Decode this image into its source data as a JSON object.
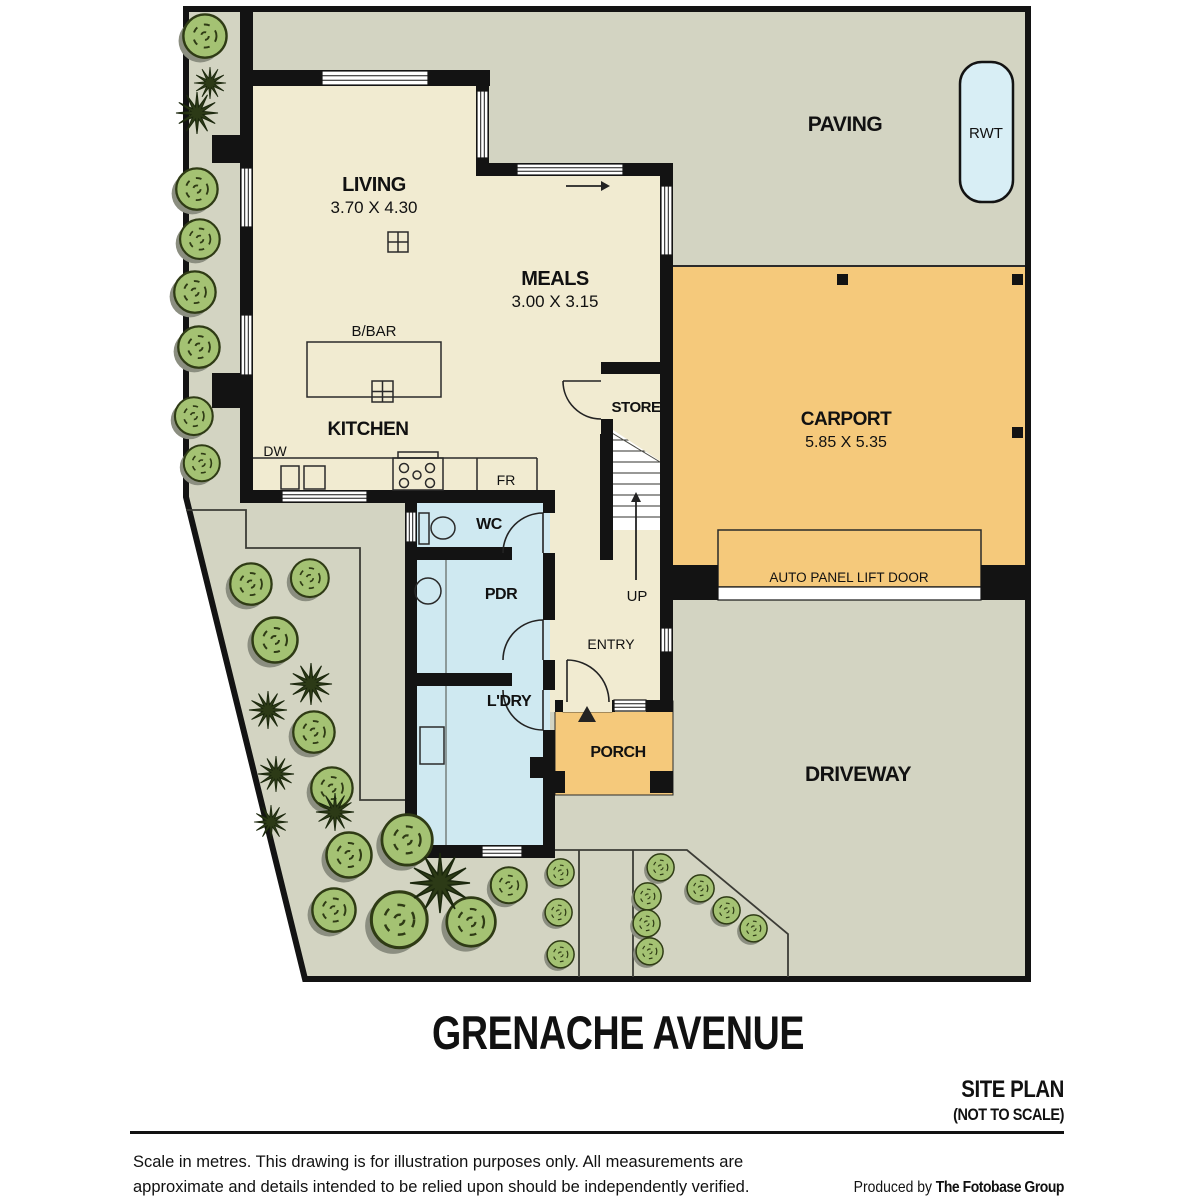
{
  "colors": {
    "site_grey": "#d3d4c2",
    "floor_cream": "#f1ebd1",
    "carport_orange": "#f5c97b",
    "wet_blue": "#cfe9f1",
    "rwt_blue": "#d8eef5",
    "wall_black": "#131313",
    "bush_green": "#a4c273",
    "bush_outline": "#2f3b15",
    "bush_shadow": "#8b8e80",
    "spiky_green": "#2c3a16",
    "line_dark": "#3c3c36",
    "text_dark": "#111111"
  },
  "plan": {
    "rooms": {
      "living": {
        "name": "LIVING",
        "dims": "3.70 X 4.30"
      },
      "meals": {
        "name": "MEALS",
        "dims": "3.00 X 3.15"
      },
      "kitchen": {
        "name": "KITCHEN"
      },
      "bbar": {
        "name": "B/BAR"
      },
      "store": {
        "name": "STORE"
      },
      "wc": {
        "name": "WC"
      },
      "pdr": {
        "name": "PDR"
      },
      "ldry": {
        "name": "L'DRY"
      },
      "entry": {
        "name": "ENTRY"
      },
      "porch": {
        "name": "PORCH"
      },
      "carport": {
        "name": "CARPORT",
        "dims": "5.85 X 5.35"
      }
    },
    "labels": {
      "up": "UP",
      "dw": "DW",
      "fr": "FR",
      "rwt": "RWT",
      "paving": "PAVING",
      "driveway": "DRIVEWAY",
      "lift_door": "AUTO PANEL LIFT DOOR"
    }
  },
  "street": {
    "name": "GRENACHE AVENUE"
  },
  "titleblock": {
    "plan_type": "SITE PLAN",
    "scale_note": "(NOT TO SCALE)",
    "disclaimer_line1": "Scale in metres. This drawing is for illustration purposes only. All measurements are",
    "disclaimer_line2": "approximate and details intended to be relied upon should be independently verified.",
    "credit_prefix": "Produced by ",
    "credit_name": "The Fotobase Group"
  }
}
